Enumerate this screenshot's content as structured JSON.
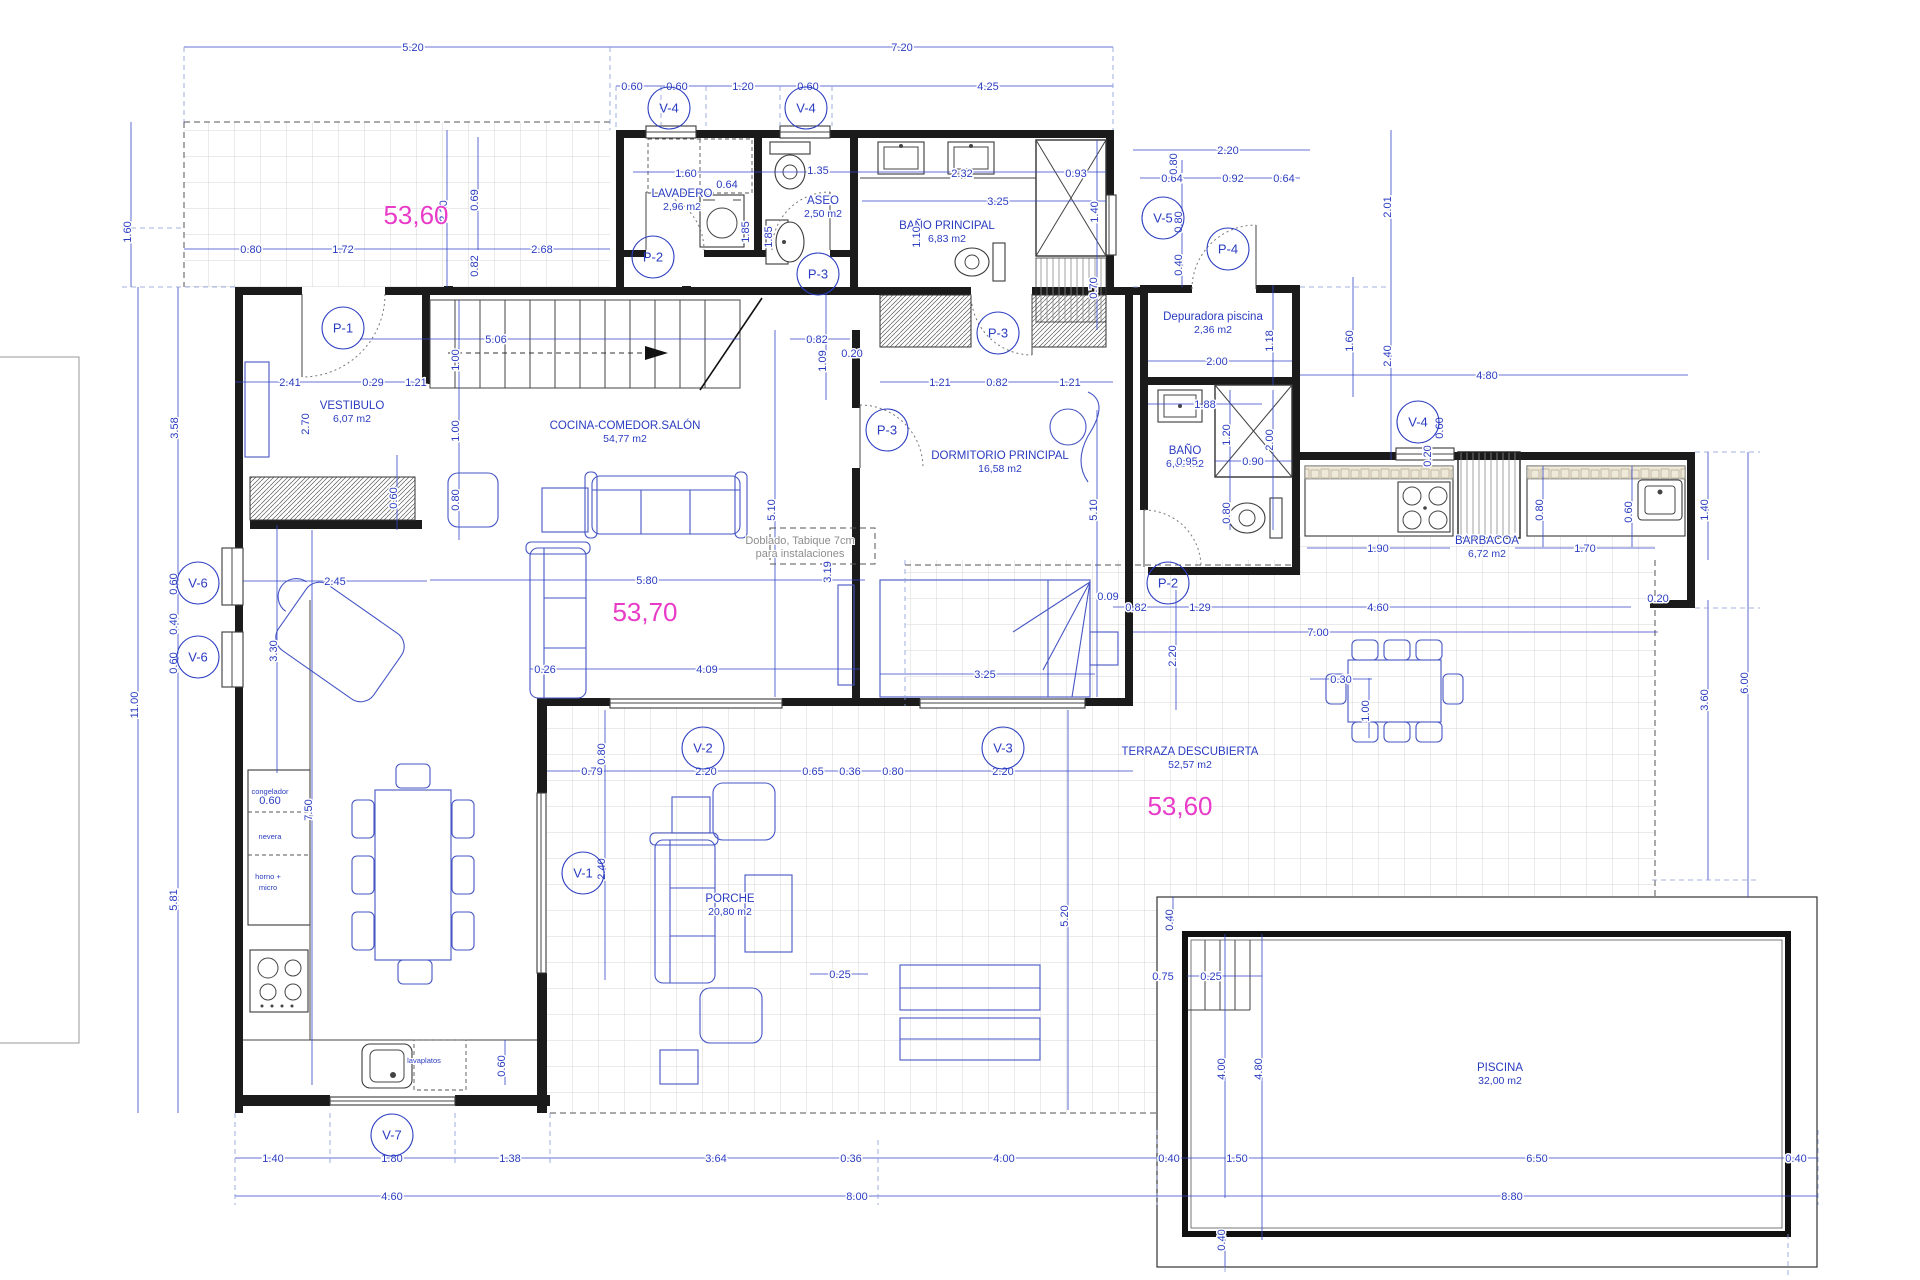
{
  "drawing": {
    "type": "architectural-floor-plan",
    "units": "meters",
    "accent_blue": "#2a3cc0",
    "wall_color": "#1b1b1b",
    "highlight_pink": "#e83bc8"
  },
  "rooms": [
    {
      "name": "LAVADERO",
      "area": "2,96 m2",
      "x": 682,
      "y": 199
    },
    {
      "name": "ASEO",
      "area": "2,50 m2",
      "x": 823,
      "y": 206
    },
    {
      "name": "BAÑO PRINCIPAL",
      "area": "6,83 m2",
      "x": 947,
      "y": 231
    },
    {
      "name": "Depuradora piscina",
      "area": "2,36 m2",
      "x": 1213,
      "y": 322
    },
    {
      "name": "VESTIBULO",
      "area": "6,07 m2",
      "x": 352,
      "y": 411
    },
    {
      "name": "COCINA-COMEDOR.SALÓN",
      "area": "54,77 m2",
      "x": 625,
      "y": 431
    },
    {
      "name": "DORMITORIO PRINCIPAL",
      "area": "16,58 m2",
      "x": 1000,
      "y": 461
    },
    {
      "name": "BAÑO",
      "area": "6,63 m2",
      "x": 1185,
      "y": 456
    },
    {
      "name": "BARBACOA",
      "area": "6,72 m2",
      "x": 1487,
      "y": 546
    },
    {
      "name": "TERRAZA DESCUBIERTA",
      "area": "52,57 m2",
      "x": 1190,
      "y": 757
    },
    {
      "name": "PORCHE",
      "area": "20,80 m2",
      "x": 730,
      "y": 904
    },
    {
      "name": "PISCINA",
      "area": "32,00 m2",
      "x": 1500,
      "y": 1073
    }
  ],
  "pink_labels": [
    {
      "text": "53,60",
      "x": 416,
      "y": 216
    },
    {
      "text": "53,70",
      "x": 645,
      "y": 613
    },
    {
      "text": "53,60",
      "x": 1180,
      "y": 807
    }
  ],
  "tags": [
    {
      "t": "V-4",
      "x": 669,
      "y": 108
    },
    {
      "t": "V-4",
      "x": 806,
      "y": 108
    },
    {
      "t": "V-5",
      "x": 1163,
      "y": 218
    },
    {
      "t": "P-4",
      "x": 1228,
      "y": 249
    },
    {
      "t": "P-2",
      "x": 653,
      "y": 257
    },
    {
      "t": "P-3",
      "x": 818,
      "y": 274
    },
    {
      "t": "P-1",
      "x": 343,
      "y": 328
    },
    {
      "t": "P-3",
      "x": 998,
      "y": 333
    },
    {
      "t": "P-3",
      "x": 887,
      "y": 430
    },
    {
      "t": "V-4",
      "x": 1418,
      "y": 422
    },
    {
      "t": "V-6",
      "x": 198,
      "y": 583
    },
    {
      "t": "V-6",
      "x": 198,
      "y": 657
    },
    {
      "t": "P-2",
      "x": 1168,
      "y": 583
    },
    {
      "t": "V-2",
      "x": 703,
      "y": 748
    },
    {
      "t": "V-3",
      "x": 1003,
      "y": 748
    },
    {
      "t": "V-1",
      "x": 583,
      "y": 873
    },
    {
      "t": "V-7",
      "x": 392,
      "y": 1135
    }
  ],
  "dims": [
    [
      "5.20",
      413,
      47,
      0
    ],
    [
      "7.20",
      902,
      47,
      0
    ],
    [
      "0.60",
      632,
      86,
      0
    ],
    [
      "0.60",
      677,
      86,
      0
    ],
    [
      "1.20",
      743,
      86,
      0
    ],
    [
      "0.60",
      808,
      86,
      0
    ],
    [
      "4.25",
      988,
      86,
      0
    ],
    [
      "2.20",
      1228,
      150,
      0
    ],
    [
      "0.64",
      1172,
      178,
      0
    ],
    [
      "0.92",
      1233,
      178,
      0
    ],
    [
      "0.64",
      1284,
      178,
      0
    ],
    [
      "1.60",
      686,
      173,
      0
    ],
    [
      "0.64",
      727,
      184,
      0
    ],
    [
      "1.35",
      818,
      170,
      0
    ],
    [
      "2.32",
      962,
      173,
      0
    ],
    [
      "0.93",
      1076,
      173,
      0
    ],
    [
      "3.25",
      998,
      201,
      0
    ],
    [
      "0.80",
      251,
      249,
      0
    ],
    [
      "1.72",
      343,
      249,
      0
    ],
    [
      "2.68",
      542,
      249,
      0
    ],
    [
      "2.00",
      1217,
      361,
      0
    ],
    [
      "5.06",
      496,
      339,
      0
    ],
    [
      "2.41",
      290,
      382,
      0
    ],
    [
      "0.29",
      373,
      382,
      0
    ],
    [
      "1.21",
      416,
      382,
      0
    ],
    [
      "0.82",
      817,
      339,
      0
    ],
    [
      "0.20",
      852,
      353,
      0
    ],
    [
      "1.21",
      940,
      382,
      0
    ],
    [
      "0.82",
      997,
      382,
      0
    ],
    [
      "1.21",
      1070,
      382,
      0
    ],
    [
      "1.88",
      1205,
      404,
      0
    ],
    [
      "0.90",
      1253,
      461,
      0
    ],
    [
      "0.95",
      1187,
      461,
      0
    ],
    [
      "4.80",
      1487,
      375,
      0
    ],
    [
      "2.45",
      335,
      581,
      0
    ],
    [
      "5.80",
      647,
      580,
      0
    ],
    [
      "0.26",
      545,
      669,
      0
    ],
    [
      "4.09",
      707,
      669,
      0
    ],
    [
      "3.25",
      985,
      674,
      0
    ],
    [
      "1.90",
      1378,
      548,
      0
    ],
    [
      "1.70",
      1585,
      548,
      0
    ],
    [
      "0.09",
      1108,
      596,
      0
    ],
    [
      "0.82",
      1136,
      607,
      0
    ],
    [
      "1.29",
      1200,
      607,
      0
    ],
    [
      "4.60",
      1378,
      607,
      0
    ],
    [
      "7.00",
      1318,
      632,
      0
    ],
    [
      "0.30",
      1341,
      679,
      0
    ],
    [
      "0.20",
      1658,
      598,
      0
    ],
    [
      "0.79",
      592,
      771,
      0
    ],
    [
      "2.20",
      706,
      771,
      0
    ],
    [
      "0.65",
      813,
      771,
      0
    ],
    [
      "0.36",
      850,
      771,
      0
    ],
    [
      "0.80",
      893,
      771,
      0
    ],
    [
      "2.20",
      1003,
      771,
      0
    ],
    [
      "0.25",
      840,
      974,
      0
    ],
    [
      "0.75",
      1163,
      976,
      0
    ],
    [
      "0.25",
      1211,
      976,
      0
    ],
    [
      "1.40",
      273,
      1158,
      0
    ],
    [
      "1.80",
      392,
      1158,
      0
    ],
    [
      "1.38",
      510,
      1158,
      0
    ],
    [
      "3.64",
      716,
      1158,
      0
    ],
    [
      "0.36",
      851,
      1158,
      0
    ],
    [
      "4.00",
      1004,
      1158,
      0
    ],
    [
      "0.40",
      1169,
      1158,
      0
    ],
    [
      "1.50",
      1237,
      1158,
      0
    ],
    [
      "6.50",
      1537,
      1158,
      0
    ],
    [
      "0.40",
      1796,
      1158,
      0
    ],
    [
      "4.60",
      392,
      1196,
      0
    ],
    [
      "8.00",
      857,
      1196,
      0
    ],
    [
      "8.80",
      1512,
      1196,
      0
    ],
    [
      "0.60",
      270,
      800,
      0
    ],
    [
      "1.60",
      131,
      228,
      1
    ],
    [
      "0.80",
      1177,
      160,
      1
    ],
    [
      "2.01",
      1391,
      203,
      1
    ],
    [
      "1.40",
      1098,
      208,
      1
    ],
    [
      "2.20",
      447,
      207,
      1
    ],
    [
      "0.69",
      478,
      196,
      1
    ],
    [
      "0.82",
      478,
      262,
      1
    ],
    [
      "1.85",
      749,
      228,
      1
    ],
    [
      "1.85",
      772,
      233,
      1
    ],
    [
      "1.10",
      920,
      233,
      1
    ],
    [
      "0.80",
      1182,
      218,
      1
    ],
    [
      "0.40",
      1182,
      261,
      1
    ],
    [
      "1.18",
      1273,
      337,
      1
    ],
    [
      "1.60",
      1353,
      337,
      1
    ],
    [
      "2.40",
      1391,
      352,
      1
    ],
    [
      "0.70",
      1097,
      284,
      1
    ],
    [
      "3.58",
      178,
      424,
      1
    ],
    [
      "2.70",
      309,
      420,
      1
    ],
    [
      "1.00",
      459,
      356,
      1
    ],
    [
      "1.00",
      459,
      427,
      1
    ],
    [
      "0.80",
      459,
      496,
      1
    ],
    [
      "1.09",
      826,
      357,
      1
    ],
    [
      "1.20",
      1230,
      431,
      1
    ],
    [
      "2.00",
      1273,
      436,
      1
    ],
    [
      "0.60",
      1443,
      424,
      1
    ],
    [
      "0.20",
      1431,
      452,
      1
    ],
    [
      "5.10",
      775,
      506,
      1
    ],
    [
      "5.10",
      1097,
      506,
      1
    ],
    [
      "0.80",
      1230,
      509,
      1
    ],
    [
      "0.80",
      1543,
      506,
      1
    ],
    [
      "0.60",
      1632,
      508,
      1
    ],
    [
      "1.40",
      1708,
      506,
      1
    ],
    [
      "3.60",
      1708,
      696,
      1
    ],
    [
      "6.00",
      1748,
      679,
      1
    ],
    [
      "0.60",
      397,
      494,
      1
    ],
    [
      "0.60",
      177,
      580,
      1
    ],
    [
      "0.40",
      177,
      620,
      1
    ],
    [
      "0.60",
      177,
      659,
      1
    ],
    [
      "3.30",
      277,
      647,
      1
    ],
    [
      "11.00",
      138,
      701,
      1
    ],
    [
      "7.50",
      312,
      806,
      1
    ],
    [
      "5.81",
      177,
      896,
      1
    ],
    [
      "2.40",
      605,
      865,
      1
    ],
    [
      "0.80",
      605,
      750,
      1
    ],
    [
      "2.20",
      1176,
      652,
      1
    ],
    [
      "1.00",
      1369,
      707,
      1
    ],
    [
      "5.20",
      1068,
      912,
      1
    ],
    [
      "0.40",
      1173,
      916,
      1
    ],
    [
      "3.19",
      831,
      568,
      1
    ],
    [
      "4.00",
      1225,
      1065,
      1
    ],
    [
      "4.80",
      1262,
      1065,
      1
    ],
    [
      "0.40",
      1225,
      1236,
      1
    ],
    [
      "0.60",
      505,
      1062,
      1
    ]
  ],
  "small_labels": [
    {
      "t": "congelador",
      "x": 270,
      "y": 794
    },
    {
      "t": "nevera",
      "x": 270,
      "y": 839
    },
    {
      "t": "horno +",
      "x": 268,
      "y": 879
    },
    {
      "t": "micro",
      "x": 268,
      "y": 890
    },
    {
      "t": "lavaplatos",
      "x": 424,
      "y": 1063
    }
  ],
  "note": {
    "x": 800,
    "y": 544,
    "lines": [
      "Doblado, Tabique 7cm",
      "para instalaciones"
    ]
  }
}
